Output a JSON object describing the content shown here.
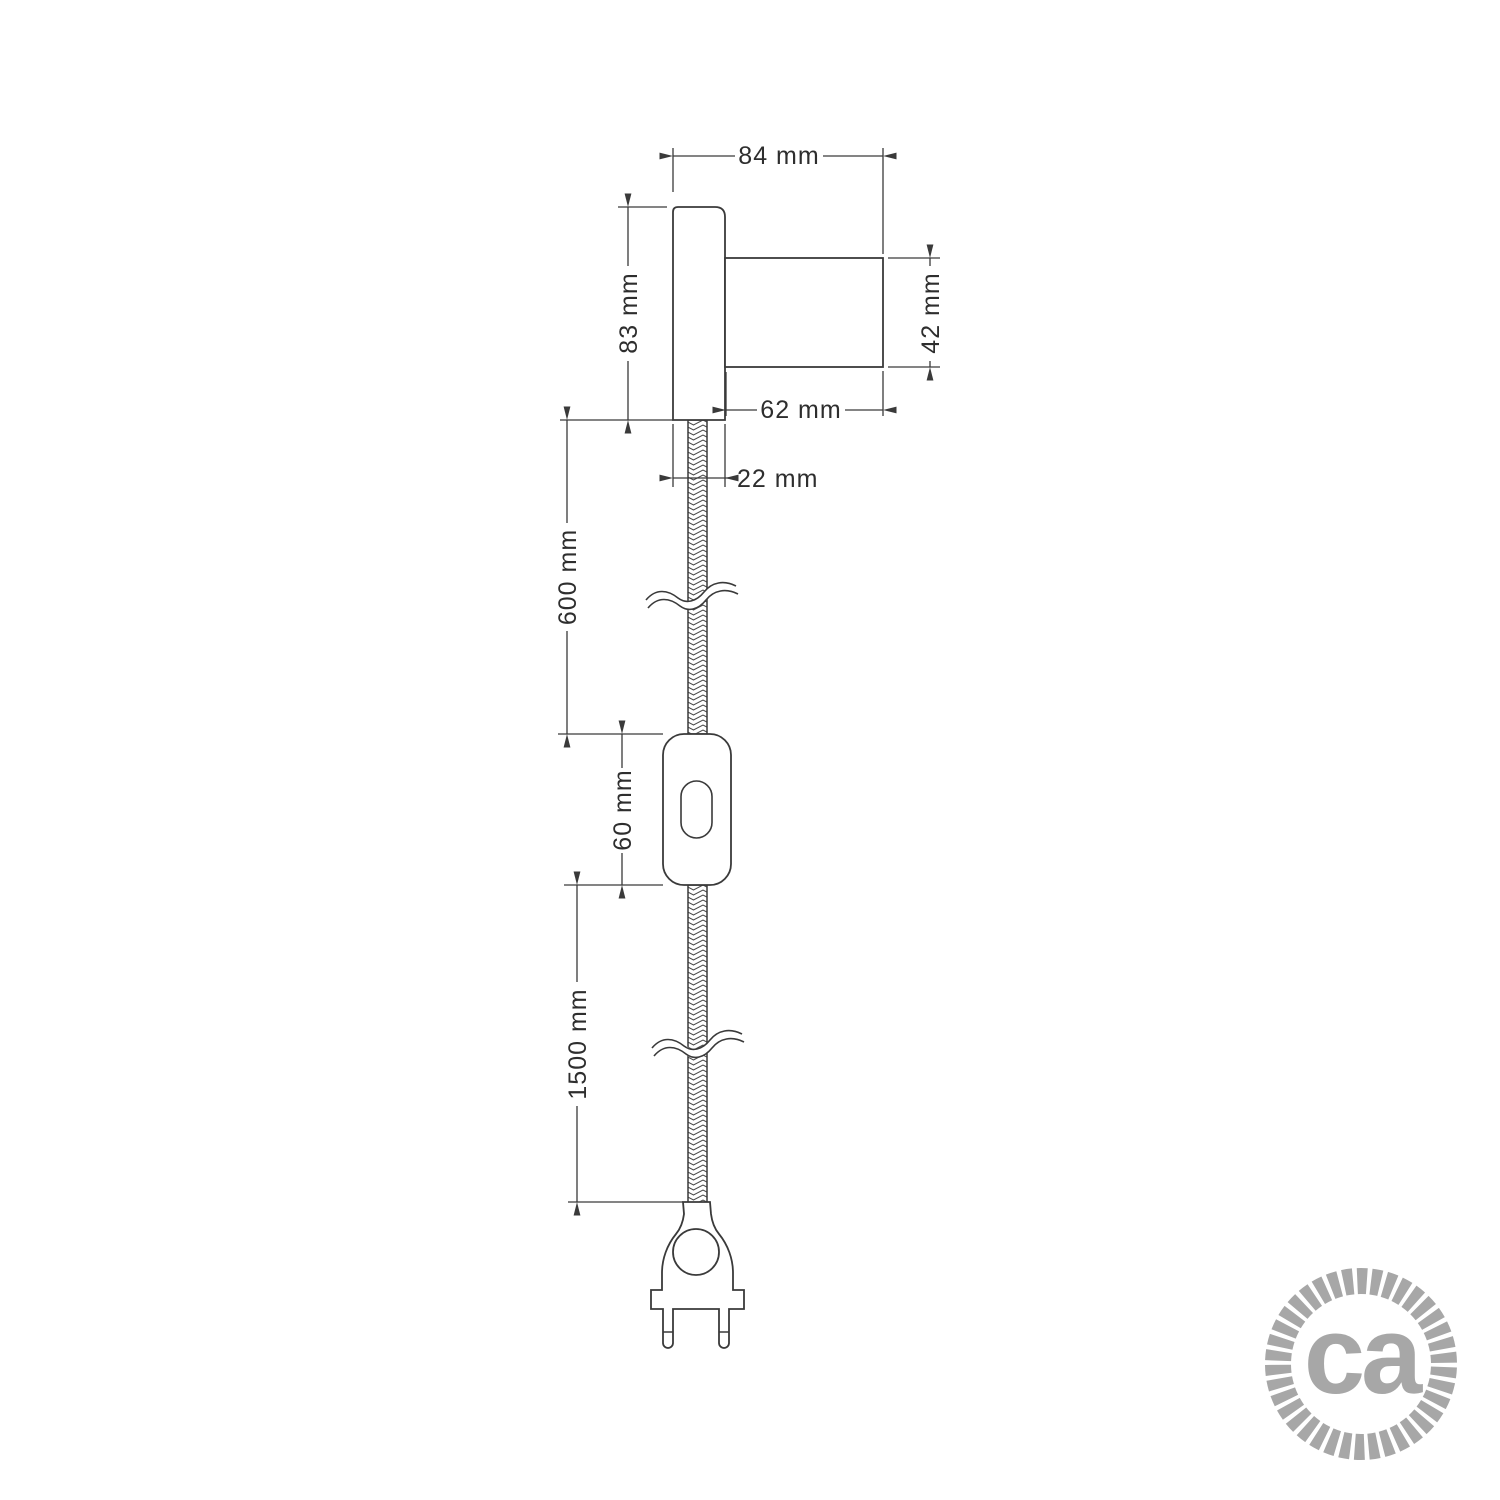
{
  "drawing": {
    "type": "technical-dimension-drawing",
    "subject": "wall spotlight with textile cable, inline switch and two-pin plug",
    "line_color": "#3a3a3a",
    "text_color": "#2e2e2e",
    "dimensions": {
      "overall_width": {
        "label": "84 mm"
      },
      "base_height": {
        "label": "83 mm"
      },
      "socket_diameter": {
        "label": "42 mm"
      },
      "socket_length": {
        "label": "62 mm"
      },
      "base_thickness": {
        "label": "22 mm"
      },
      "cable_upper_length": {
        "label": "600 mm"
      },
      "switch_length": {
        "label": "60 mm"
      },
      "cable_lower_length": {
        "label": "1500 mm"
      }
    }
  },
  "logo": {
    "text": "ca",
    "color": "#a7a7a7"
  }
}
